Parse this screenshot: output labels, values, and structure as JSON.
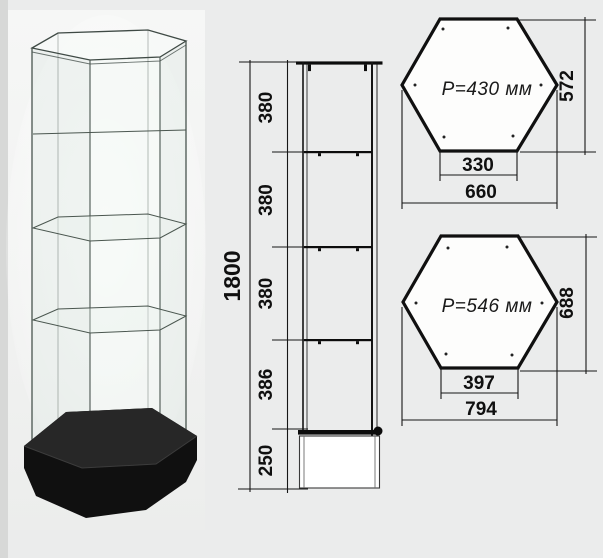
{
  "page": {
    "background_color": "#ebecec",
    "line_color": "#141414",
    "subject": "hexagonal glass showcase with black plinth, dimensioned drawing"
  },
  "elevation": {
    "total_height": "1800",
    "segments": [
      "380",
      "380",
      "380",
      "386",
      "250"
    ]
  },
  "hex_top": {
    "perimeter_label": "P=430 мм",
    "height": "572",
    "edge_width": "330",
    "overall_width": "660"
  },
  "hex_bottom": {
    "perimeter_label": "P=546 мм",
    "height": "688",
    "edge_width": "397",
    "overall_width": "794"
  },
  "photo": {
    "base_color": "#101010",
    "glass_tint": "#e4ede7"
  }
}
